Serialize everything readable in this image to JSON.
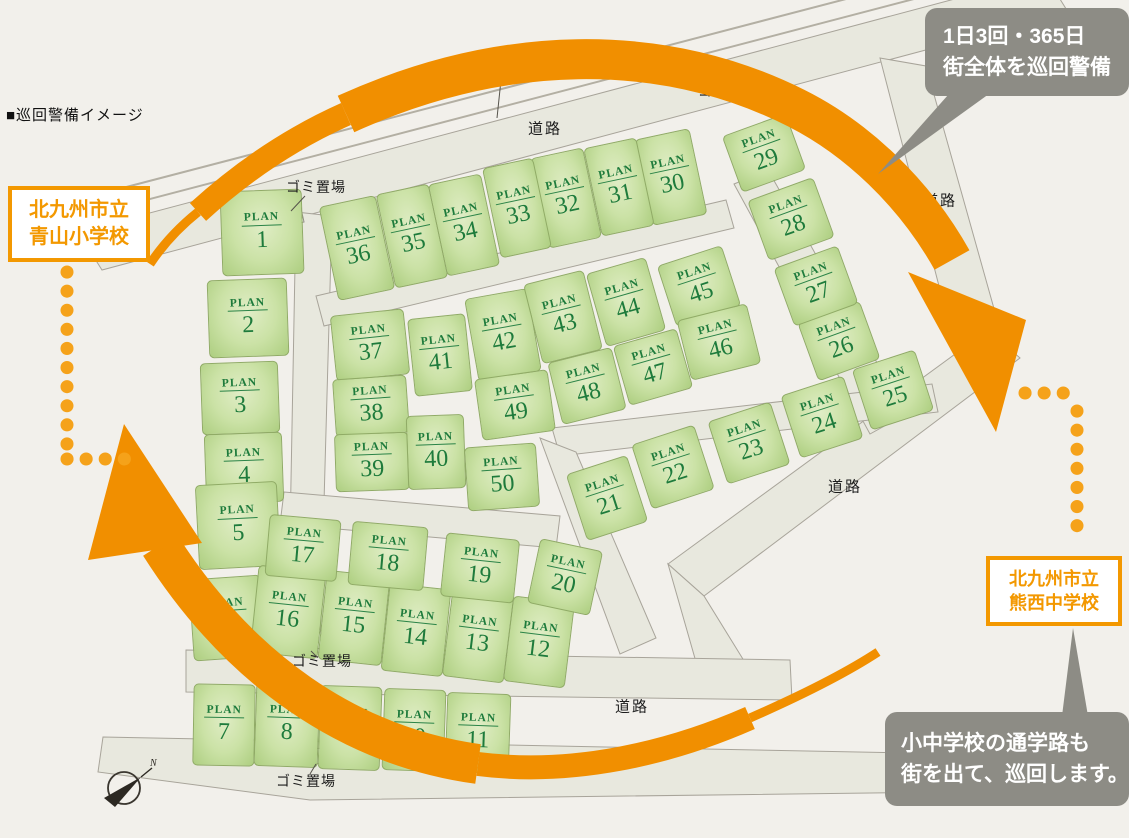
{
  "title": "■巡回警備イメージ",
  "map_labels": {
    "plan": "PLAN",
    "road": "道路",
    "sidewalk": "歩道",
    "garbage": "ゴミ置場",
    "compass_n": "N"
  },
  "schools": {
    "elementary": {
      "line1": "北九州市立",
      "line2": "青山小学校"
    },
    "junior_high": {
      "line1": "北九州市立",
      "line2": "熊西中学校"
    }
  },
  "bubbles": {
    "patrol": {
      "line1": "1日3回・365日",
      "line2": "街全体を巡回警備"
    },
    "school_route": {
      "line1": "小中学校の通学路も",
      "line2": "街を出て、巡回します。"
    }
  },
  "road_labels": [
    {
      "x": 545,
      "y": 128
    },
    {
      "x": 940,
      "y": 200
    },
    {
      "x": 845,
      "y": 486
    },
    {
      "x": 632,
      "y": 706
    }
  ],
  "garbage_labels": [
    {
      "x": 316,
      "y": 187
    },
    {
      "x": 728,
      "y": 91
    },
    {
      "x": 322,
      "y": 661
    },
    {
      "x": 306,
      "y": 781
    }
  ],
  "lots": [
    {
      "n": 1,
      "x": 262,
      "y": 232,
      "w": 82,
      "h": 85,
      "r": -2
    },
    {
      "n": 2,
      "x": 248,
      "y": 318,
      "w": 80,
      "h": 78,
      "r": -2
    },
    {
      "n": 3,
      "x": 240,
      "y": 398,
      "w": 78,
      "h": 72,
      "r": -2
    },
    {
      "n": 4,
      "x": 244,
      "y": 468,
      "w": 78,
      "h": 70,
      "r": -2
    },
    {
      "n": 5,
      "x": 238,
      "y": 525,
      "w": 82,
      "h": 85,
      "r": -3
    },
    {
      "n": 6,
      "x": 227,
      "y": 618,
      "w": 72,
      "h": 82,
      "r": -4
    },
    {
      "n": 7,
      "x": 224,
      "y": 725,
      "w": 62,
      "h": 82,
      "r": 1
    },
    {
      "n": 8,
      "x": 287,
      "y": 725,
      "w": 64,
      "h": 84,
      "r": 2
    },
    {
      "n": 9,
      "x": 350,
      "y": 728,
      "w": 62,
      "h": 84,
      "r": 2
    },
    {
      "n": 10,
      "x": 414,
      "y": 730,
      "w": 62,
      "h": 82,
      "r": 2
    },
    {
      "n": 11,
      "x": 478,
      "y": 733,
      "w": 64,
      "h": 80,
      "r": 2
    },
    {
      "n": 12,
      "x": 539,
      "y": 642,
      "w": 62,
      "h": 86,
      "r": 7
    },
    {
      "n": 13,
      "x": 478,
      "y": 636,
      "w": 62,
      "h": 88,
      "r": 7
    },
    {
      "n": 14,
      "x": 416,
      "y": 630,
      "w": 62,
      "h": 88,
      "r": 6
    },
    {
      "n": 15,
      "x": 354,
      "y": 618,
      "w": 64,
      "h": 90,
      "r": 6
    },
    {
      "n": 16,
      "x": 288,
      "y": 612,
      "w": 68,
      "h": 88,
      "r": 6
    },
    {
      "n": 17,
      "x": 303,
      "y": 548,
      "w": 72,
      "h": 62,
      "r": 5
    },
    {
      "n": 18,
      "x": 388,
      "y": 556,
      "w": 76,
      "h": 64,
      "r": 5
    },
    {
      "n": 19,
      "x": 480,
      "y": 568,
      "w": 74,
      "h": 64,
      "r": 6
    },
    {
      "n": 20,
      "x": 565,
      "y": 577,
      "w": 64,
      "h": 66,
      "r": 12
    },
    {
      "n": 21,
      "x": 607,
      "y": 498,
      "w": 64,
      "h": 70,
      "r": -18
    },
    {
      "n": 22,
      "x": 673,
      "y": 467,
      "w": 66,
      "h": 68,
      "r": -18
    },
    {
      "n": 23,
      "x": 749,
      "y": 443,
      "w": 66,
      "h": 66,
      "r": -18
    },
    {
      "n": 24,
      "x": 822,
      "y": 417,
      "w": 66,
      "h": 66,
      "r": -18
    },
    {
      "n": 25,
      "x": 893,
      "y": 390,
      "w": 66,
      "h": 64,
      "r": -18
    },
    {
      "n": 26,
      "x": 839,
      "y": 341,
      "w": 66,
      "h": 62,
      "r": -20
    },
    {
      "n": 27,
      "x": 816,
      "y": 286,
      "w": 68,
      "h": 62,
      "r": -20
    },
    {
      "n": 28,
      "x": 791,
      "y": 219,
      "w": 70,
      "h": 64,
      "r": -20
    },
    {
      "n": 29,
      "x": 764,
      "y": 153,
      "w": 68,
      "h": 60,
      "r": -20
    },
    {
      "n": 30,
      "x": 671,
      "y": 177,
      "w": 56,
      "h": 88,
      "r": -12
    },
    {
      "n": 31,
      "x": 619,
      "y": 187,
      "w": 54,
      "h": 90,
      "r": -12
    },
    {
      "n": 32,
      "x": 566,
      "y": 198,
      "w": 54,
      "h": 92,
      "r": -12
    },
    {
      "n": 33,
      "x": 517,
      "y": 208,
      "w": 52,
      "h": 92,
      "r": -12
    },
    {
      "n": 34,
      "x": 464,
      "y": 225,
      "w": 54,
      "h": 94,
      "r": -12
    },
    {
      "n": 35,
      "x": 412,
      "y": 236,
      "w": 54,
      "h": 96,
      "r": -12
    },
    {
      "n": 36,
      "x": 357,
      "y": 248,
      "w": 58,
      "h": 96,
      "r": -12
    },
    {
      "n": 37,
      "x": 370,
      "y": 345,
      "w": 74,
      "h": 66,
      "r": -6
    },
    {
      "n": 38,
      "x": 371,
      "y": 406,
      "w": 74,
      "h": 58,
      "r": -4
    },
    {
      "n": 39,
      "x": 372,
      "y": 462,
      "w": 74,
      "h": 58,
      "r": -2
    },
    {
      "n": 40,
      "x": 436,
      "y": 452,
      "w": 58,
      "h": 74,
      "r": -2
    },
    {
      "n": 41,
      "x": 440,
      "y": 355,
      "w": 58,
      "h": 78,
      "r": -6
    },
    {
      "n": 42,
      "x": 503,
      "y": 335,
      "w": 64,
      "h": 84,
      "r": -10
    },
    {
      "n": 43,
      "x": 563,
      "y": 317,
      "w": 62,
      "h": 82,
      "r": -14
    },
    {
      "n": 44,
      "x": 626,
      "y": 302,
      "w": 62,
      "h": 76,
      "r": -16
    },
    {
      "n": 45,
      "x": 699,
      "y": 286,
      "w": 68,
      "h": 64,
      "r": -18
    },
    {
      "n": 46,
      "x": 719,
      "y": 342,
      "w": 72,
      "h": 62,
      "r": -14
    },
    {
      "n": 47,
      "x": 653,
      "y": 367,
      "w": 66,
      "h": 62,
      "r": -16
    },
    {
      "n": 48,
      "x": 587,
      "y": 386,
      "w": 66,
      "h": 64,
      "r": -14
    },
    {
      "n": 49,
      "x": 515,
      "y": 405,
      "w": 74,
      "h": 62,
      "r": -8
    },
    {
      "n": 50,
      "x": 502,
      "y": 477,
      "w": 72,
      "h": 64,
      "r": -4
    }
  ],
  "colors": {
    "background": "#f2f0eb",
    "accent_orange": "#f18f00",
    "dot_orange": "#f5a21a",
    "school_orange": "#f39800",
    "lot_green_edge": "#adce80",
    "lot_green_center": "#e0edc6",
    "plan_text_green": "#1e7b3c",
    "road_fill": "#e8e8de",
    "road_stroke": "#a8a49a",
    "bubble_gray": "#8d8c85"
  }
}
